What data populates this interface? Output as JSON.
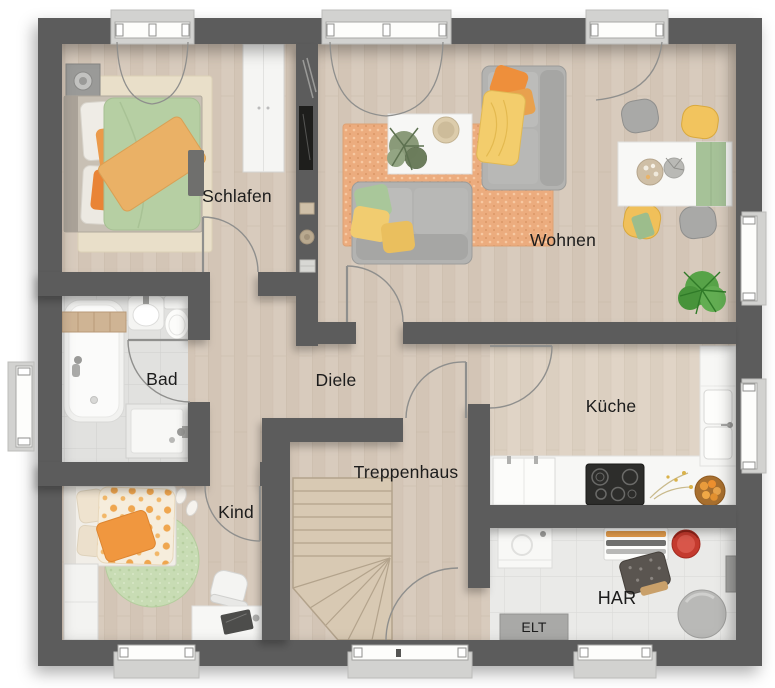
{
  "floorplan": {
    "rooms": [
      {
        "name": "Schlafen"
      },
      {
        "name": "Wohnen"
      },
      {
        "name": "Bad"
      },
      {
        "name": "Diele"
      },
      {
        "name": "Küche"
      },
      {
        "name": "Treppenhaus"
      },
      {
        "name": "Kind"
      },
      {
        "name": "HAR"
      },
      {
        "name": "ELT"
      }
    ],
    "colors": {
      "wall": "#5b5b5b",
      "wood_floor": "#d7cabc",
      "kitchen_floor": "#ded2c4",
      "bath_tile": "#e1e1df",
      "har_tile": "#eaeae8",
      "rug_orange": "#ecac7e",
      "accent_orange": "#ee8f3b",
      "accent_yellow": "#f2c45e",
      "accent_green": "#a9c79a",
      "sofa_gray": "#b3b3b1",
      "furniture_white": "#f7f7f5",
      "stairs_wood": "#d8c9b3",
      "window_symbol": "#fdfdfb",
      "label_text": "#1c1c1c"
    },
    "openings": {
      "windows_top": 3,
      "windows_right": 2,
      "windows_left": 1,
      "windows_bottom": 2,
      "entrance_door_bottom": 1
    }
  }
}
